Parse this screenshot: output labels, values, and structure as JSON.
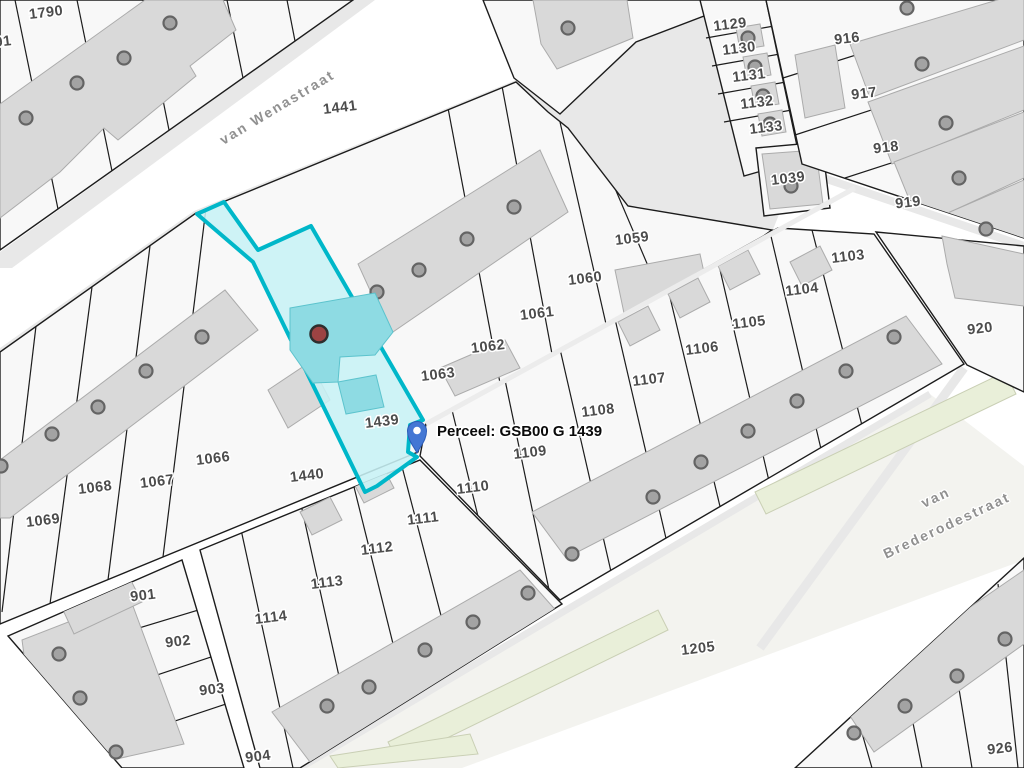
{
  "map": {
    "streets": {
      "wenastraat": "van Wenastraat",
      "brederodestraat_line1": "van",
      "brederodestraat_line2": "Brederodestraat",
      "left_edge_fragment": "aat"
    },
    "marker": {
      "label": "Perceel: GSB00 G 1439",
      "pin_x": 417,
      "pin_y": 452
    },
    "highlighted_parcel": "1439",
    "parcel_labels": [
      {
        "t": "1790",
        "x": 46,
        "y": 12
      },
      {
        "t": "91",
        "x": 3,
        "y": 41
      },
      {
        "t": "1441",
        "x": 340,
        "y": 107
      },
      {
        "t": "1129",
        "x": 730,
        "y": 24
      },
      {
        "t": "1130",
        "x": 739,
        "y": 48
      },
      {
        "t": "1131",
        "x": 749,
        "y": 75
      },
      {
        "t": "1132",
        "x": 757,
        "y": 102
      },
      {
        "t": "1133",
        "x": 766,
        "y": 127
      },
      {
        "t": "1039",
        "x": 788,
        "y": 178
      },
      {
        "t": "916",
        "x": 847,
        "y": 38
      },
      {
        "t": "917",
        "x": 864,
        "y": 93
      },
      {
        "t": "918",
        "x": 886,
        "y": 147
      },
      {
        "t": "919",
        "x": 908,
        "y": 202
      },
      {
        "t": "920",
        "x": 980,
        "y": 328
      },
      {
        "t": "1059",
        "x": 632,
        "y": 238
      },
      {
        "t": "1060",
        "x": 585,
        "y": 278
      },
      {
        "t": "1061",
        "x": 537,
        "y": 313
      },
      {
        "t": "1062",
        "x": 488,
        "y": 346
      },
      {
        "t": "1063",
        "x": 438,
        "y": 374
      },
      {
        "t": "1103",
        "x": 848,
        "y": 256
      },
      {
        "t": "1104",
        "x": 802,
        "y": 289
      },
      {
        "t": "1105",
        "x": 749,
        "y": 322
      },
      {
        "t": "1106",
        "x": 702,
        "y": 348
      },
      {
        "t": "1107",
        "x": 649,
        "y": 379
      },
      {
        "t": "1108",
        "x": 598,
        "y": 410
      },
      {
        "t": "1066",
        "x": 213,
        "y": 458
      },
      {
        "t": "1067",
        "x": 157,
        "y": 481
      },
      {
        "t": "1068",
        "x": 95,
        "y": 487
      },
      {
        "t": "1069",
        "x": 43,
        "y": 520
      },
      {
        "t": "1439",
        "x": 382,
        "y": 421
      },
      {
        "t": "1440",
        "x": 307,
        "y": 475
      },
      {
        "t": "1109",
        "x": 530,
        "y": 452
      },
      {
        "t": "1110",
        "x": 473,
        "y": 487
      },
      {
        "t": "1111",
        "x": 423,
        "y": 518
      },
      {
        "t": "1112",
        "x": 377,
        "y": 548
      },
      {
        "t": "1113",
        "x": 327,
        "y": 582
      },
      {
        "t": "1114",
        "x": 271,
        "y": 617
      },
      {
        "t": "901",
        "x": 143,
        "y": 595
      },
      {
        "t": "902",
        "x": 178,
        "y": 641
      },
      {
        "t": "903",
        "x": 212,
        "y": 689
      },
      {
        "t": "904",
        "x": 258,
        "y": 756
      },
      {
        "t": "1205",
        "x": 698,
        "y": 648
      },
      {
        "t": "926",
        "x": 1000,
        "y": 748
      }
    ],
    "building_dots": [
      {
        "x": 170,
        "y": 23
      },
      {
        "x": 124,
        "y": 58
      },
      {
        "x": 77,
        "y": 83
      },
      {
        "x": 26,
        "y": 118
      },
      {
        "x": 568,
        "y": 28
      },
      {
        "x": 748,
        "y": 38
      },
      {
        "x": 755,
        "y": 67
      },
      {
        "x": 763,
        "y": 96
      },
      {
        "x": 770,
        "y": 124
      },
      {
        "x": 791,
        "y": 186
      },
      {
        "x": 907,
        "y": 8
      },
      {
        "x": 922,
        "y": 64
      },
      {
        "x": 946,
        "y": 123
      },
      {
        "x": 959,
        "y": 178
      },
      {
        "x": 986,
        "y": 229
      },
      {
        "x": 514,
        "y": 207
      },
      {
        "x": 467,
        "y": 239
      },
      {
        "x": 419,
        "y": 270
      },
      {
        "x": 377,
        "y": 292
      },
      {
        "x": 202,
        "y": 337
      },
      {
        "x": 146,
        "y": 371
      },
      {
        "x": 98,
        "y": 407
      },
      {
        "x": 52,
        "y": 434
      },
      {
        "x": 1,
        "y": 466
      },
      {
        "x": 894,
        "y": 337
      },
      {
        "x": 846,
        "y": 371
      },
      {
        "x": 797,
        "y": 401
      },
      {
        "x": 748,
        "y": 431
      },
      {
        "x": 701,
        "y": 462
      },
      {
        "x": 653,
        "y": 497
      },
      {
        "x": 572,
        "y": 554
      },
      {
        "x": 528,
        "y": 593
      },
      {
        "x": 473,
        "y": 622
      },
      {
        "x": 425,
        "y": 650
      },
      {
        "x": 369,
        "y": 687
      },
      {
        "x": 327,
        "y": 706
      },
      {
        "x": 59,
        "y": 654
      },
      {
        "x": 80,
        "y": 698
      },
      {
        "x": 116,
        "y": 752
      },
      {
        "x": 1005,
        "y": 639
      },
      {
        "x": 957,
        "y": 676
      },
      {
        "x": 905,
        "y": 706
      },
      {
        "x": 854,
        "y": 733
      }
    ],
    "colors": {
      "background": "#ffffff",
      "block_fill": "#f8f8f8",
      "block_stroke": "#1c1c1c",
      "building_fill": "#d9d9d9",
      "building_stroke": "#ababab",
      "sidewalk": "#e8e8e8",
      "road_band": "#f3f3ef",
      "green_strip": "#e9efd9",
      "green_strip_stroke": "#c9cfb4",
      "dot_fill": "#a3a3a3",
      "dot_stroke": "#646464",
      "label_color": "#4c4c4c",
      "street_label_color": "#909090",
      "highlight_stroke": "#00b7c9",
      "highlight_fill": "#c7f1f5",
      "highlight_building": "#8edbe3",
      "marker_blue": "#4377d4",
      "red_dot": "#9c4343"
    }
  }
}
